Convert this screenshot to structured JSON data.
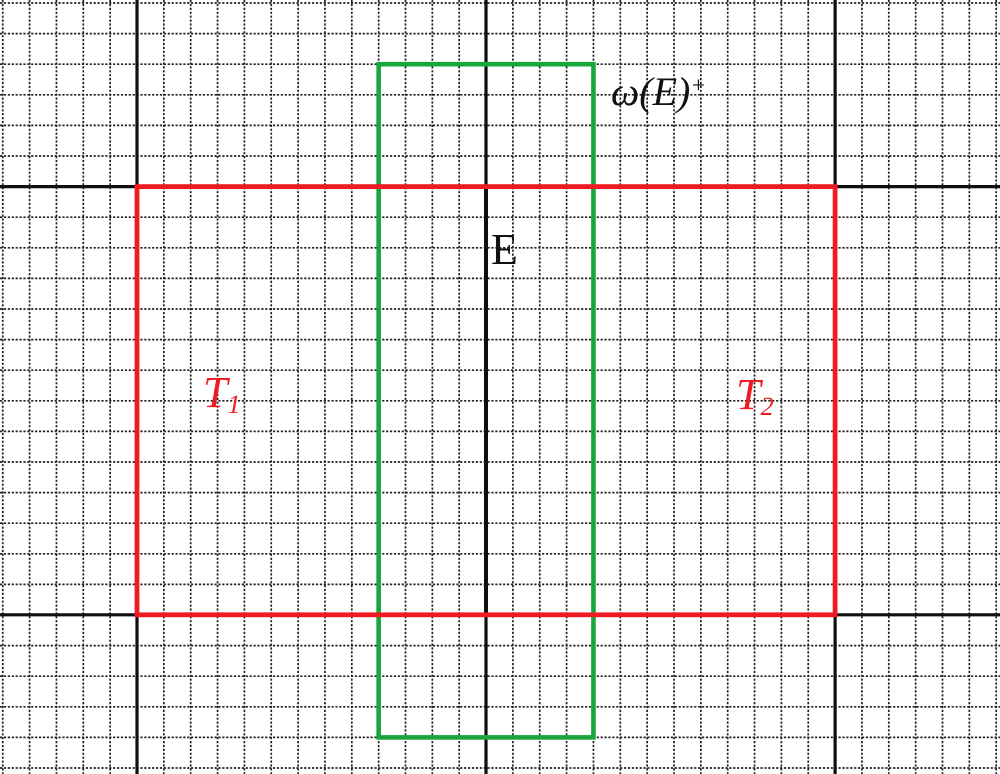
{
  "diagram": {
    "description": "Dotted grid with black lattice lines, red tile rectangle pair T1/T2, green window rectangle omega(E)+, and central vertical edge E",
    "background_color": "#ffffff",
    "grid": {
      "offset_x": 2.75,
      "spacing_x": 26.85,
      "cols": 38,
      "offset_y": 3,
      "spacing_y": 30.6,
      "rows": 26,
      "color": "#212121",
      "dash": "2.2 1.7",
      "line_width": 1.7
    },
    "major_lines": {
      "color": "#0f0f0f",
      "line_width": 3.2,
      "vertical_x": [
        137,
        486,
        835.1
      ],
      "horizontal_y": [
        186.6,
        614.8
      ]
    },
    "edge_segment": {
      "x": 486,
      "y1": 186.6,
      "y2": 614.8,
      "color": "#0f0f0f",
      "line_width": 4
    },
    "rectangles": [
      {
        "id": "green-window-rect",
        "x": 378.65,
        "y": 64.2,
        "w": 214.8,
        "h": 673.2,
        "stroke": "#18a63c",
        "line_width": 4.6
      },
      {
        "id": "red-tiles-rect",
        "x": 137,
        "y": 186.6,
        "w": 698.1,
        "h": 428.2,
        "stroke": "#ee1b23",
        "line_width": 4.8
      }
    ],
    "labels": [
      {
        "base": "ω(E)",
        "sup": "+",
        "x": 611,
        "y": 72,
        "size": 40,
        "color": "#111111",
        "italic": true
      },
      {
        "base": "E",
        "x": 491,
        "y": 228,
        "size": 44,
        "color": "#111111",
        "italic": false
      },
      {
        "base": "T",
        "sub": "1",
        "x": 203,
        "y": 371,
        "size": 44,
        "color": "#ee1b23",
        "italic": true
      },
      {
        "base": "T",
        "sub": "2",
        "x": 736,
        "y": 373,
        "size": 44,
        "color": "#ee1b23",
        "italic": true
      }
    ]
  }
}
